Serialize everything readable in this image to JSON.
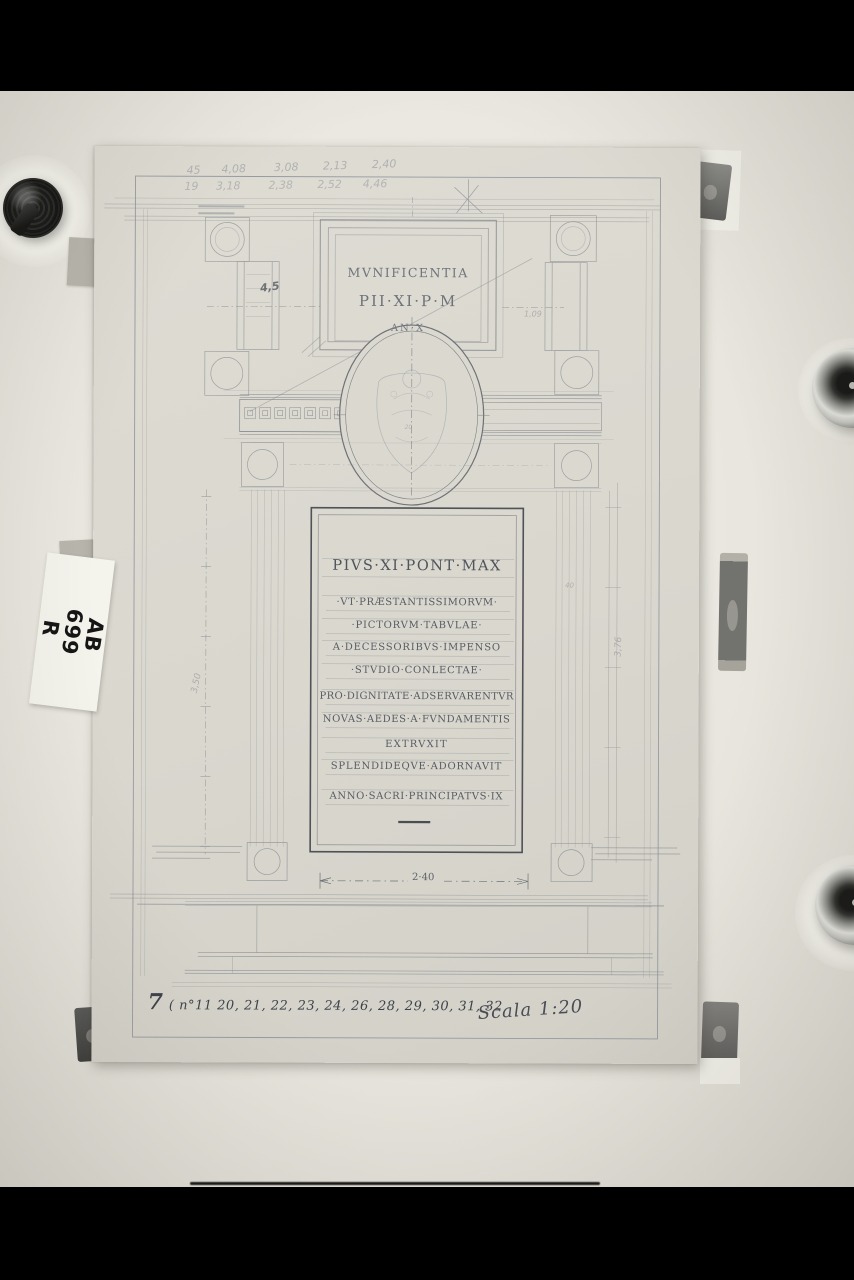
{
  "photo": {
    "archival_label": {
      "line1": "AB",
      "line2": "699",
      "line3": "R"
    }
  },
  "sheet": {
    "pencil_calculations": {
      "row1": "45      4,08        3,08       2,13       2,40",
      "row2": "19     3,18        2,38       2,52      4,46"
    },
    "attic_inscription": {
      "line1": "MVNIFICENTIA",
      "line2": "PII·XI·P·M",
      "line3": "AN·X"
    },
    "main_inscription": {
      "title": "PIVS·XI·PONT·MAX",
      "lines": [
        "·VT·PRÆSTANTISSIMORVM·",
        "·PICTORVM·TABVLAE·",
        "A·DECESSORIBVS·IMPENSO",
        "·STVDIO·CONLECTAE·",
        "PRO·DIGNITATE·ADSERVARENTVR",
        "NOVAS·AEDES·A·FVNDAMENTIS",
        "EXTRVXIT",
        "SPLENDIDEQVE·ADORNAVIT",
        "ANNO·SACRI·PRINCIPATVS·IX"
      ]
    },
    "dimensions": {
      "d_45": "4,5",
      "d_109": "1,09",
      "d_20": "20",
      "d_350": "3,50",
      "d_376": "3,76",
      "d_40": "40",
      "d_240": "2·40"
    },
    "footer": {
      "note_prefix": "7",
      "note_body": "( n°11  20, 21, 22, 23, 24, 26, 28, 29, 30, 31, 32",
      "scale": "Scala 1:20"
    }
  },
  "colors": {
    "letterbox": "#000000",
    "paper_background": "#e9e7df",
    "sheet": "#d9d7ce",
    "pencil": "#7c8086",
    "ink": "#3f424a"
  }
}
